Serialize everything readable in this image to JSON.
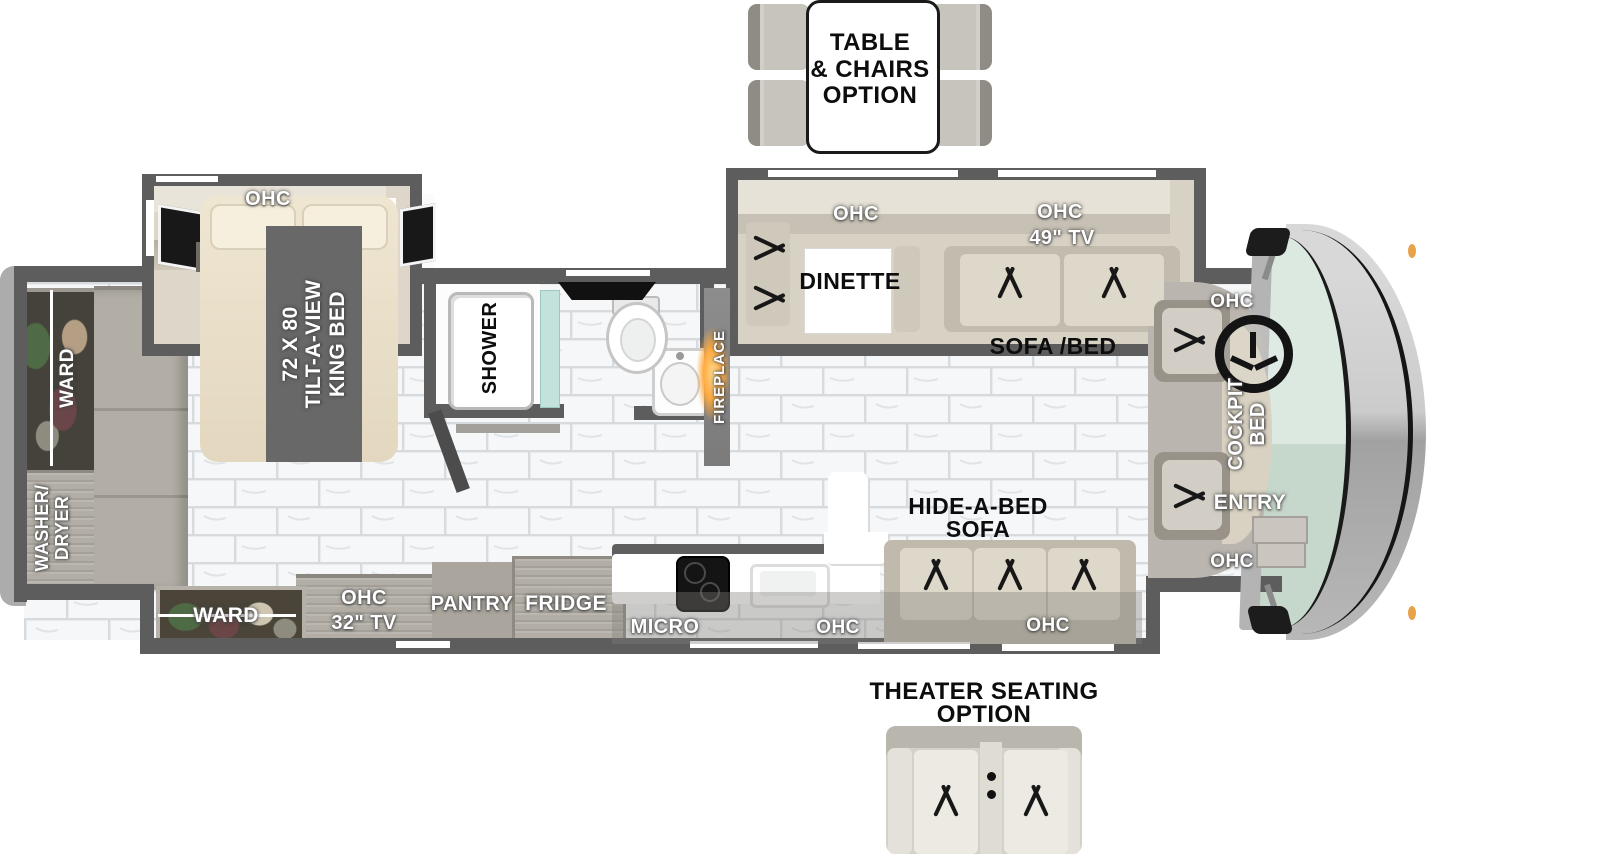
{
  "options": {
    "table_chairs": {
      "line1": "TABLE",
      "line2": "& CHAIRS",
      "line3": "OPTION"
    },
    "theater": {
      "line1": "THEATER SEATING",
      "line2": "OPTION"
    }
  },
  "bedroom": {
    "ohc": "OHC",
    "bed_line1": "72 X 80",
    "bed_line2": "TILT-A-VIEW",
    "bed_line3": "KING BED",
    "ward": "WARD",
    "washer_line1": "WASHER/",
    "washer_line2": "DRYER"
  },
  "bath": {
    "shower": "SHOWER",
    "fireplace": "FIREPLACE"
  },
  "living": {
    "dinette_ohc": "OHC",
    "dinette": "DINETTE",
    "tv_ohc": "OHC",
    "tv": "49\" TV",
    "sofa_bed": "SOFA /BED",
    "hide_line1": "HIDE-A-BED",
    "hide_line2": "SOFA",
    "sofa_ohc": "OHC"
  },
  "kitchen": {
    "micro": "MICRO",
    "ohc": "OHC",
    "fridge": "FRIDGE",
    "pantry": "PANTRY",
    "tv_line1": "OHC",
    "tv_line2": "32\" TV",
    "ward": "WARD"
  },
  "cockpit": {
    "ohc_top": "OHC",
    "bed_line1": "COCKPIT",
    "bed_line2": "BED",
    "entry": "ENTRY",
    "ohc_bottom": "OHC"
  }
}
